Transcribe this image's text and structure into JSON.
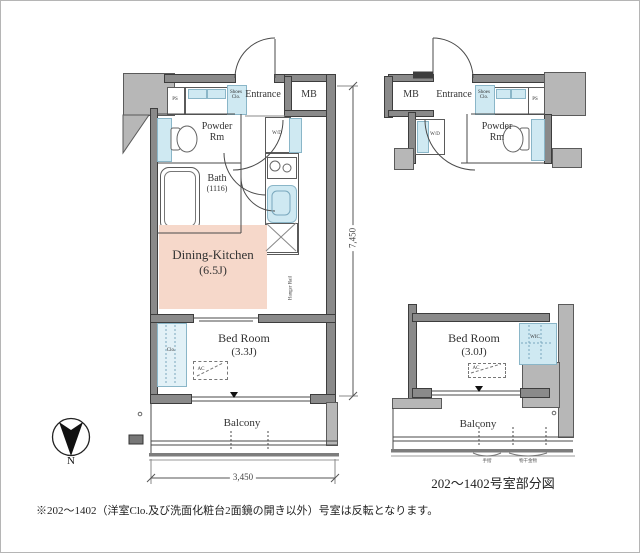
{
  "page": {
    "note": "※202〜1402（洋室Clo.及び洗面化粧台2面鏡の開き以外）号室は反転となります。"
  },
  "compass": {
    "north_label": "N"
  },
  "main_plan": {
    "entrance": "Entrance",
    "mb": "MB",
    "shoes_closet": "Shoes Clo.",
    "ps": "PS",
    "powder_room": "Powder Rm",
    "washer_dryer": "W/D",
    "bath": "Bath",
    "bath_size": "(1116)",
    "dining_kitchen": "Dining-Kitchen",
    "dining_kitchen_size": "(6.5J)",
    "bed_room": "Bed Room",
    "bed_room_size": "(3.3J)",
    "closet": "Clo.",
    "ac": "AC",
    "hanger_rail": "Hanger Rail",
    "balcony": "Balcony",
    "dim_width": "3,450",
    "dim_height": "7,450"
  },
  "right_plan": {
    "entrance": "Entrance",
    "mb": "MB",
    "shoes_closet": "Shoes Clo.",
    "ps": "PS",
    "powder_room": "Powder Rm",
    "washer_dryer": "W/D",
    "bed_room": "Bed Room",
    "bed_room_size": "(3.0J)",
    "wic": "WIC",
    "ac": "AC",
    "balcony": "Balcony",
    "micro_label_1": "手摺",
    "micro_label_2": "物干金物",
    "caption": "202〜1402号室部分図"
  },
  "colors": {
    "wall": "#8a8a8a",
    "neighbor_block": "#b7b7b7",
    "fixture_blue": "#cfe9f2",
    "dining_kitchen_pink": "#f6d8ca",
    "line": "#4a4a4a"
  }
}
